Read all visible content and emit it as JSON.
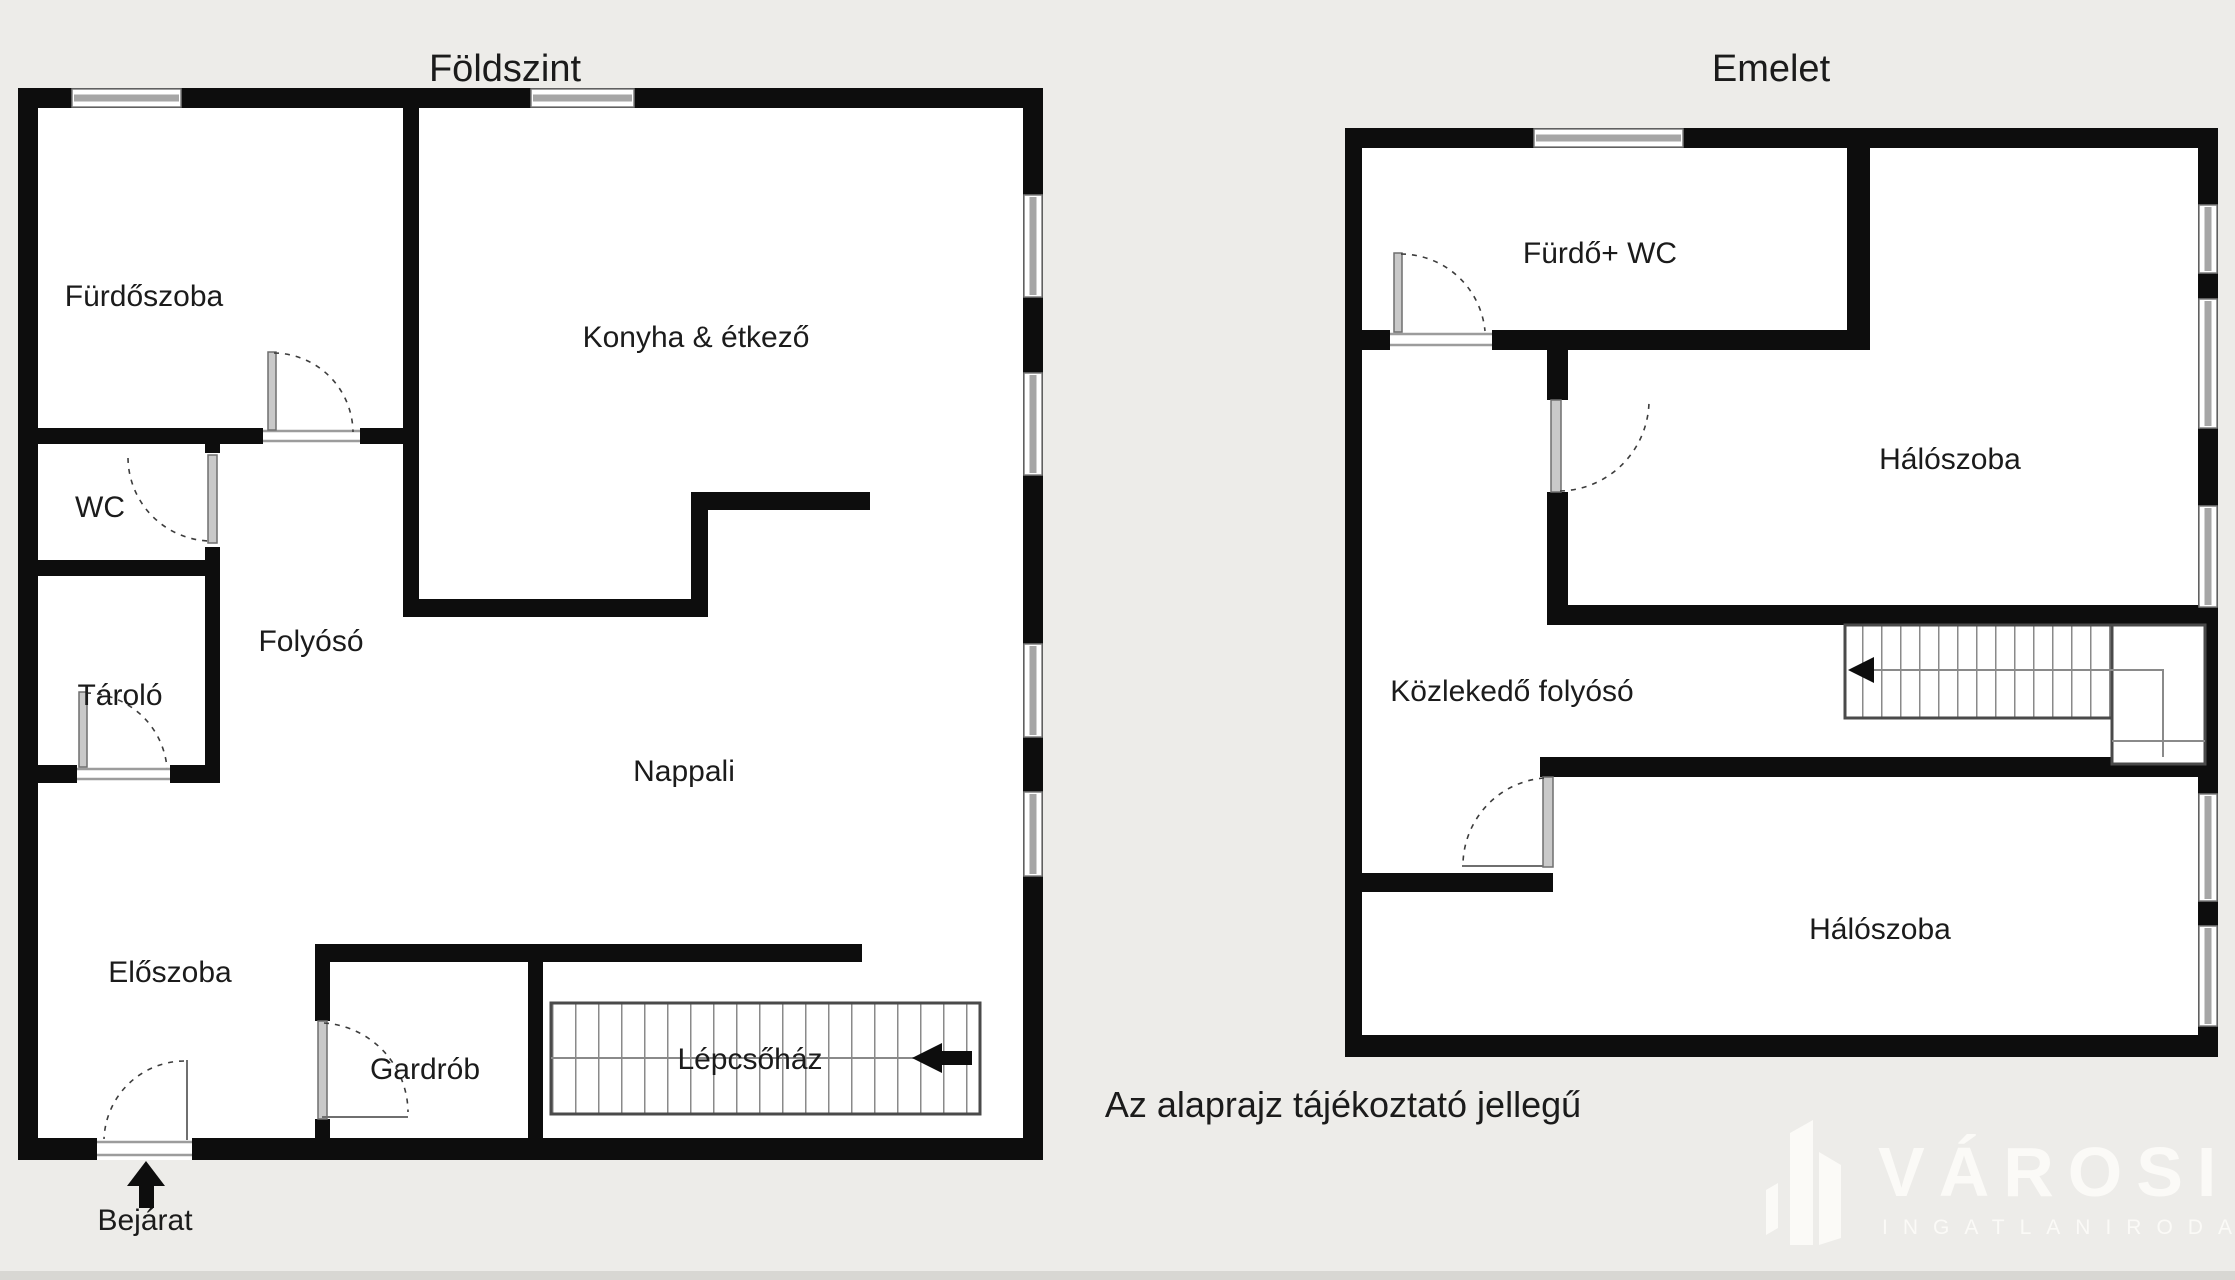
{
  "colors": {
    "background": "#edece9",
    "wall": "#0d0d0d",
    "floor": "#ffffff",
    "window_gray": "#a6a6a6",
    "door_gray": "#c9c9c9",
    "text": "#1b1b1b",
    "logo": "#fbfaf7",
    "bottom_bar": "#d8d7d3"
  },
  "ground_floor": {
    "title": "Földszint",
    "rooms": {
      "bathroom": "Fürdőszoba",
      "kitchen": "Konyha & étkező",
      "wc": "WC",
      "storage": "Tároló",
      "hallway": "Folyósó",
      "living_room": "Nappali",
      "entry_hall": "Előszoba",
      "wardrobe": "Gardrób",
      "staircase": "Lépcsőház"
    },
    "entrance_label": "Bejárat"
  },
  "upper_floor": {
    "title": "Emelet",
    "rooms": {
      "bathroom_wc": "Fürdő+ WC",
      "bedroom_1": "Hálószoba",
      "corridor": "Közlekedő folyósó",
      "bedroom_2": "Hálószoba"
    }
  },
  "disclaimer": "Az alaprajz tájékoztató jellegű",
  "logo": {
    "icon": "building-icon",
    "name": "VÁROSI",
    "subtitle": "INGATLANIRODA"
  }
}
